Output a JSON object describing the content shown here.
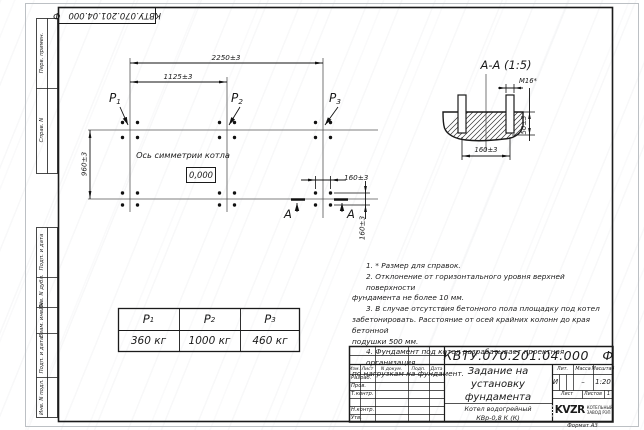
{
  "corner_stamp": {
    "text": "КВТУ.070.201.04.000   Ф"
  },
  "sidebar": {
    "labels": [
      "Перв. примен.",
      "Справ. N",
      "Подп. и дата",
      "Инв. N дубл.",
      "Взам. инв. N",
      "Подп. и дата",
      "Инв. N подл."
    ]
  },
  "plan": {
    "p_labels": [
      {
        "base": "Р",
        "sub": "1"
      },
      {
        "base": "Р",
        "sub": "2"
      },
      {
        "base": "Р",
        "sub": "3"
      }
    ],
    "dim_2250": "2250±3",
    "dim_1125": "1125±3",
    "dim_960": "960±3",
    "dim_160_horizontal": "160±3",
    "dim_160_vertical": "160±3",
    "axis_label": "Ось симметрии котла",
    "elevation": "0,000",
    "section_letter": "А"
  },
  "section_view": {
    "title": "А-А (1:5)",
    "bolt_thread": "M16*",
    "dim_height": "50±3",
    "dim_spacing": "160±3"
  },
  "notes": {
    "lines": [
      "1. * Размер для справок.",
      "2. Отклонение от горизонтального уровня верхней поверхности",
      "фундамента не более 10 мм.",
      "3. В случае отсутствия бетонного пола площадку под котел",
      "забетонировать. Расстояние от осей крайних колонн до края бетонной",
      "подушки 500 мм.",
      "4. Фундамент под котел разрабатывает проектная организация",
      "по нагрузкам на фундамент."
    ]
  },
  "load_table": {
    "headers": [
      {
        "base": "Р",
        "sub": "1"
      },
      {
        "base": "Р",
        "sub": "2"
      },
      {
        "base": "Р",
        "sub": "3"
      }
    ],
    "values": [
      "360 кг",
      "1000 кг",
      "460 кг"
    ]
  },
  "title_block": {
    "doc_number": "КВТУ.070.201.04.000   Ф",
    "title_lines": [
      "Задание на",
      "установку",
      "фундамента"
    ],
    "product_lines": [
      "Котел водогрейный",
      "КВр-0,8 К (К)"
    ],
    "header_cols": [
      "Изм.",
      "Лист",
      "N докум.",
      "Подп.",
      "Дата"
    ],
    "row_labels": [
      "Разраб.",
      "Пров.",
      "Т.контр.",
      "",
      "Н.контр.",
      "Утв."
    ],
    "lit_header": "Лит.",
    "mass_header": "Масса",
    "scale_header": "Масштаб",
    "lit_value": "И",
    "mass_value": "–",
    "scale_value": "1:20",
    "sheet_label": "Лист",
    "sheets_label": "Листов",
    "sheets_value": "1",
    "logo_text": "KVZR",
    "logo_caption_lines": [
      "КОТЕЛЬНЫЙ",
      "ЗАВОД РЭП"
    ],
    "format_label": "Формат А3"
  }
}
